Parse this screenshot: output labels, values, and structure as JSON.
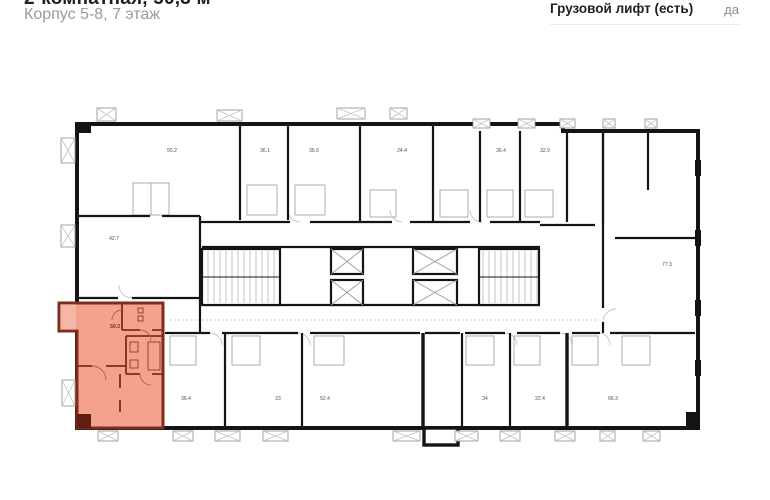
{
  "header": {
    "title": "2-комнатная, 50,3 м²",
    "subtitle": "Корпус 5-8, 7 этаж"
  },
  "specs": {
    "rows": [
      {
        "label": "Грузовой лифт (есть)",
        "value": "да"
      }
    ]
  },
  "plan": {
    "selected_unit": {
      "area": "50.3"
    },
    "units": [
      {
        "area": "55.2"
      },
      {
        "area": "36.1"
      },
      {
        "area": "35.6"
      },
      {
        "area": "24.4"
      },
      {
        "area": "36.4"
      },
      {
        "area": "32.9"
      },
      {
        "area": "77.3"
      },
      {
        "area": "42.7"
      },
      {
        "area": "36.4"
      },
      {
        "area": "23"
      },
      {
        "area": "52.4"
      },
      {
        "area": "34"
      },
      {
        "area": "22.4"
      },
      {
        "area": "66.3"
      }
    ],
    "colors": {
      "highlight_fill": "#f4a28e",
      "highlight_wall": "#7c2d1b",
      "wall": "#141414"
    }
  }
}
